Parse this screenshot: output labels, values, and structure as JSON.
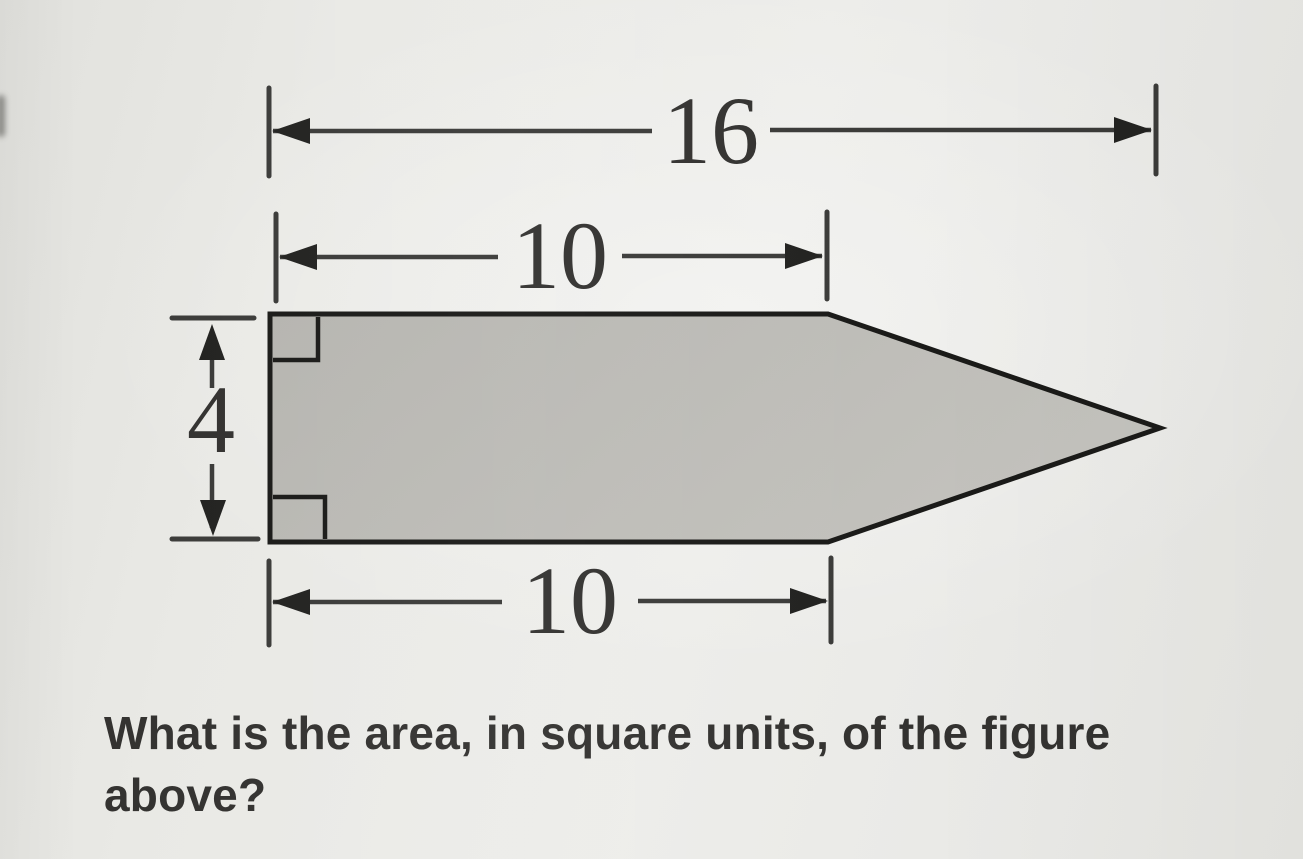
{
  "figure": {
    "description": "pentagon-arrow-shape",
    "dimensions": {
      "top": "16",
      "middle": "10",
      "left": "4",
      "bottom": "10"
    }
  },
  "question": {
    "lines": [
      "What is the area, in square units, of the figure",
      "above?"
    ]
  },
  "colors": {
    "background": "#e9e9e5",
    "shape_fill": "#b6b5b0",
    "shape_fill_light": "#c3c2bd",
    "shape_stroke": "#1a1a18",
    "dimension_line": "#3b3b39",
    "arrow_fill": "#222220",
    "text": "#333230"
  }
}
